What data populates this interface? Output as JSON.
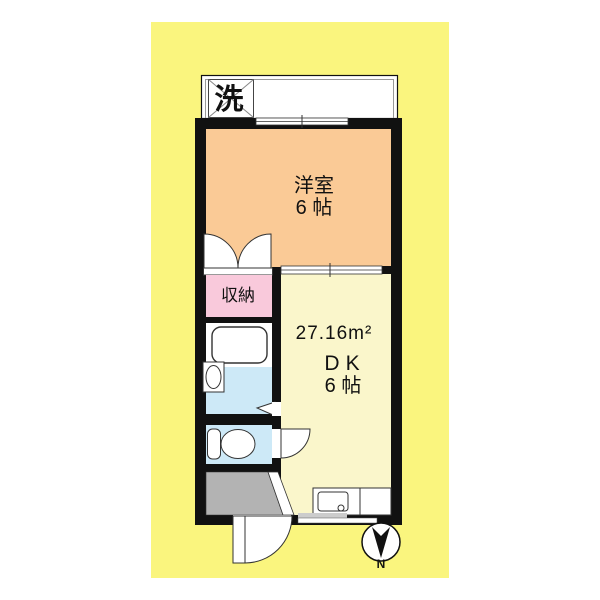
{
  "document": {
    "type": "japanese-apartment-floor-plan"
  },
  "colors": {
    "page_background": "#ffffff",
    "mat_yellow": "#FAF57E",
    "wall_black": "#111111",
    "western_room_orange": "#FACA96",
    "dk_cream": "#FAF6CB",
    "closet_pink": "#F9C9DB",
    "wet_area_blue": "#CDE9F7",
    "entrance_gray": "#B3B3B3",
    "fixture_outline": "#333333"
  },
  "labels": {
    "washer": "洗",
    "western_room": {
      "name": "洋室",
      "size": "6 帖"
    },
    "closet": "収納",
    "dk": {
      "area": "27.16m²",
      "name": "DK",
      "size": "6 帖"
    },
    "compass": "N"
  }
}
